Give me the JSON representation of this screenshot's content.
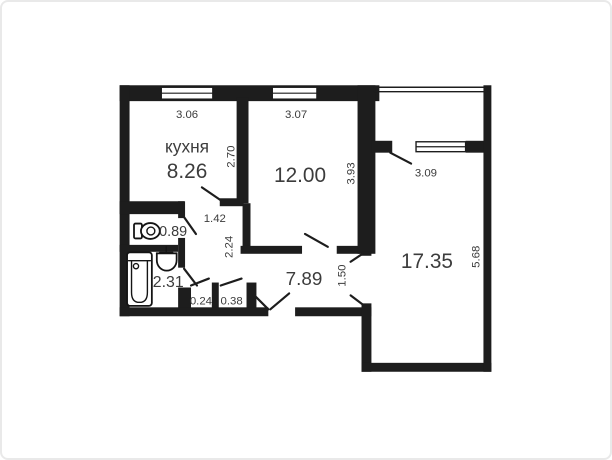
{
  "plan_title": "apartment-floor-plan",
  "colors": {
    "wall": "#1d1d1d",
    "text": "#3c3c3c",
    "background": "#ffffff",
    "frame_border": "#e9e9e9"
  },
  "rooms": {
    "kitchen": {
      "name": "кухня",
      "area": "8.26",
      "dim_width": "3.06",
      "dim_depth": "2.70"
    },
    "living": {
      "area": "12.00",
      "dim_width": "3.07",
      "dim_depth": "3.93"
    },
    "bedroom": {
      "area": "17.35",
      "dim_width": "3.09",
      "dim_depth": "5.68"
    },
    "hallway": {
      "area": "7.89",
      "dim_corridor_width": "1.42",
      "dim_corridor_length": "2.24",
      "dim_doorway": "1.50"
    },
    "wc": {
      "area": "0.89"
    },
    "bathroom": {
      "area": "2.31"
    },
    "closet_small": {
      "area": "0.24"
    },
    "closet_large": {
      "area": "0.38"
    }
  }
}
